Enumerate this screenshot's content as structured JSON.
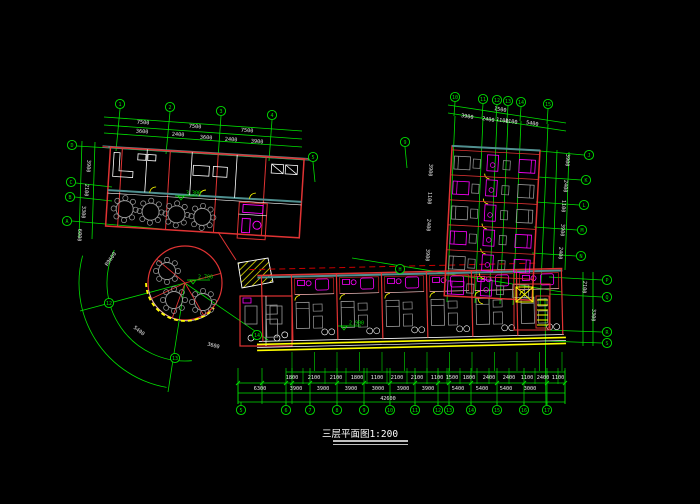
{
  "title": {
    "text": "三层平面图1:200"
  },
  "colors": {
    "background": "#000000",
    "grid_green": "#00e000",
    "wall_red": "#e03333",
    "dash_red": "#cc0000",
    "fixture_magenta": "#ff00ff",
    "accent_yellow": "#ffff00",
    "furniture_gray": "#9a9a9a",
    "wall_teal": "#4f9090",
    "dim_text": "#e8e8e8"
  },
  "grid_bubbles": [
    {
      "label": "1",
      "x": 120,
      "y": 104
    },
    {
      "label": "2",
      "x": 170,
      "y": 107
    },
    {
      "label": "3",
      "x": 221,
      "y": 111
    },
    {
      "label": "4",
      "x": 272,
      "y": 115
    },
    {
      "label": "5",
      "x": 313,
      "y": 157
    },
    {
      "label": "9",
      "x": 405,
      "y": 142
    },
    {
      "label": "H",
      "x": 400,
      "y": 269
    },
    {
      "label": "D",
      "x": 72,
      "y": 145
    },
    {
      "label": "C",
      "x": 71,
      "y": 182
    },
    {
      "label": "B",
      "x": 70,
      "y": 197
    },
    {
      "label": "A",
      "x": 67,
      "y": 221
    },
    {
      "label": "10",
      "x": 455,
      "y": 97
    },
    {
      "label": "11",
      "x": 483,
      "y": 99
    },
    {
      "label": "12",
      "x": 497,
      "y": 100
    },
    {
      "label": "13",
      "x": 508,
      "y": 101
    },
    {
      "label": "14",
      "x": 521,
      "y": 102
    },
    {
      "label": "15",
      "x": 548,
      "y": 104
    },
    {
      "label": "J",
      "x": 589,
      "y": 155
    },
    {
      "label": "K",
      "x": 586,
      "y": 180
    },
    {
      "label": "L",
      "x": 584,
      "y": 205
    },
    {
      "label": "M",
      "x": 582,
      "y": 230
    },
    {
      "label": "N",
      "x": 581,
      "y": 256
    },
    {
      "label": "P",
      "x": 607,
      "y": 280
    },
    {
      "label": "Q",
      "x": 607,
      "y": 297
    },
    {
      "label": "R",
      "x": 607,
      "y": 332
    },
    {
      "label": "S",
      "x": 607,
      "y": 343
    },
    {
      "label": "12",
      "x": 109,
      "y": 303
    },
    {
      "label": "13",
      "x": 175,
      "y": 358
    },
    {
      "label": "14",
      "x": 257,
      "y": 335
    },
    {
      "label": "5",
      "x": 241,
      "y": 410
    },
    {
      "label": "6",
      "x": 286,
      "y": 410
    },
    {
      "label": "7",
      "x": 310,
      "y": 410
    },
    {
      "label": "8",
      "x": 337,
      "y": 410
    },
    {
      "label": "9",
      "x": 364,
      "y": 410
    },
    {
      "label": "10",
      "x": 390,
      "y": 410
    },
    {
      "label": "11",
      "x": 415,
      "y": 410
    },
    {
      "label": "12",
      "x": 438,
      "y": 410
    },
    {
      "label": "13",
      "x": 449,
      "y": 410
    },
    {
      "label": "14",
      "x": 471,
      "y": 410
    },
    {
      "label": "15",
      "x": 497,
      "y": 410
    },
    {
      "label": "16",
      "x": 524,
      "y": 410
    },
    {
      "label": "17",
      "x": 547,
      "y": 410
    }
  ],
  "dim_labels": [
    {
      "t": "7500",
      "x": 143,
      "y": 124,
      "r": 4
    },
    {
      "t": "7500",
      "x": 195,
      "y": 128,
      "r": 4
    },
    {
      "t": "7500",
      "x": 247,
      "y": 132,
      "r": 4
    },
    {
      "t": "3600",
      "x": 142,
      "y": 133,
      "r": 4
    },
    {
      "t": "2400",
      "x": 178,
      "y": 136,
      "r": 4
    },
    {
      "t": "3600",
      "x": 206,
      "y": 139,
      "r": 4
    },
    {
      "t": "2400",
      "x": 231,
      "y": 141,
      "r": 4
    },
    {
      "t": "3900",
      "x": 257,
      "y": 143,
      "r": 4
    },
    {
      "t": "3900",
      "x": 87,
      "y": 166,
      "r": 94
    },
    {
      "t": "2100",
      "x": 85,
      "y": 190,
      "r": 94
    },
    {
      "t": "3300",
      "x": 82,
      "y": 212,
      "r": 94
    },
    {
      "t": "6000",
      "x": 78,
      "y": 235,
      "r": 94
    },
    {
      "t": "1500",
      "x": 500,
      "y": 111,
      "r": 9
    },
    {
      "t": "3900",
      "x": 467,
      "y": 118,
      "r": 9
    },
    {
      "t": "2400",
      "x": 488,
      "y": 121,
      "r": 9
    },
    {
      "t": "1100",
      "x": 502,
      "y": 122,
      "r": 9
    },
    {
      "t": "1100",
      "x": 511,
      "y": 123,
      "r": 9
    },
    {
      "t": "5400",
      "x": 532,
      "y": 125,
      "r": 9
    },
    {
      "t": "3900",
      "x": 429,
      "y": 170,
      "r": 94
    },
    {
      "t": "1100",
      "x": 428,
      "y": 198,
      "r": 94
    },
    {
      "t": "2400",
      "x": 427,
      "y": 225,
      "r": 94
    },
    {
      "t": "3900",
      "x": 426,
      "y": 255,
      "r": 94
    },
    {
      "t": "3900",
      "x": 566,
      "y": 160,
      "r": 94
    },
    {
      "t": "2400",
      "x": 564,
      "y": 186,
      "r": 94
    },
    {
      "t": "1100",
      "x": 562,
      "y": 206,
      "r": 94
    },
    {
      "t": "3900",
      "x": 561,
      "y": 230,
      "r": 94
    },
    {
      "t": "2400",
      "x": 559,
      "y": 253,
      "r": 94
    },
    {
      "t": "2100",
      "x": 583,
      "y": 287,
      "r": 94
    },
    {
      "t": "3300",
      "x": 592,
      "y": 315,
      "r": 94
    },
    {
      "t": "1800",
      "x": 292,
      "y": 379,
      "r": 0
    },
    {
      "t": "2100",
      "x": 314,
      "y": 379,
      "r": 0
    },
    {
      "t": "2100",
      "x": 336,
      "y": 379,
      "r": 0
    },
    {
      "t": "1800",
      "x": 357,
      "y": 379,
      "r": 0
    },
    {
      "t": "1100",
      "x": 377,
      "y": 379,
      "r": 0
    },
    {
      "t": "2100",
      "x": 397,
      "y": 379,
      "r": 0
    },
    {
      "t": "2100",
      "x": 417,
      "y": 379,
      "r": 0
    },
    {
      "t": "1100",
      "x": 437,
      "y": 379,
      "r": 0
    },
    {
      "t": "1500",
      "x": 452,
      "y": 379,
      "r": 0
    },
    {
      "t": "1800",
      "x": 469,
      "y": 379,
      "r": 0
    },
    {
      "t": "2400",
      "x": 489,
      "y": 379,
      "r": 0
    },
    {
      "t": "2400",
      "x": 509,
      "y": 379,
      "r": 0
    },
    {
      "t": "1100",
      "x": 527,
      "y": 379,
      "r": 0
    },
    {
      "t": "2400",
      "x": 543,
      "y": 379,
      "r": 0
    },
    {
      "t": "1100",
      "x": 558,
      "y": 379,
      "r": 0
    },
    {
      "t": "6300",
      "x": 260,
      "y": 390,
      "r": 0
    },
    {
      "t": "3900",
      "x": 296,
      "y": 390,
      "r": 0
    },
    {
      "t": "3900",
      "x": 323,
      "y": 390,
      "r": 0
    },
    {
      "t": "3900",
      "x": 351,
      "y": 390,
      "r": 0
    },
    {
      "t": "3000",
      "x": 378,
      "y": 390,
      "r": 0
    },
    {
      "t": "3900",
      "x": 403,
      "y": 390,
      "r": 0
    },
    {
      "t": "3900",
      "x": 428,
      "y": 390,
      "r": 0
    },
    {
      "t": "5400",
      "x": 458,
      "y": 390,
      "r": 0
    },
    {
      "t": "5400",
      "x": 482,
      "y": 390,
      "r": 0
    },
    {
      "t": "5400",
      "x": 506,
      "y": 390,
      "r": 0
    },
    {
      "t": "3000",
      "x": 530,
      "y": 390,
      "r": 0
    },
    {
      "t": "42600",
      "x": 388,
      "y": 400,
      "r": 0
    },
    {
      "t": "R9600",
      "x": 112,
      "y": 260,
      "r": -55
    },
    {
      "t": "5400",
      "x": 138,
      "y": 332,
      "r": 38
    },
    {
      "t": "3600",
      "x": 213,
      "y": 347,
      "r": 15
    }
  ],
  "level_markers": [
    {
      "t": "3.300",
      "x": 184,
      "y": 196
    },
    {
      "t": "2.700",
      "x": 196,
      "y": 280
    },
    {
      "t": "2.900",
      "x": 347,
      "y": 326
    }
  ]
}
